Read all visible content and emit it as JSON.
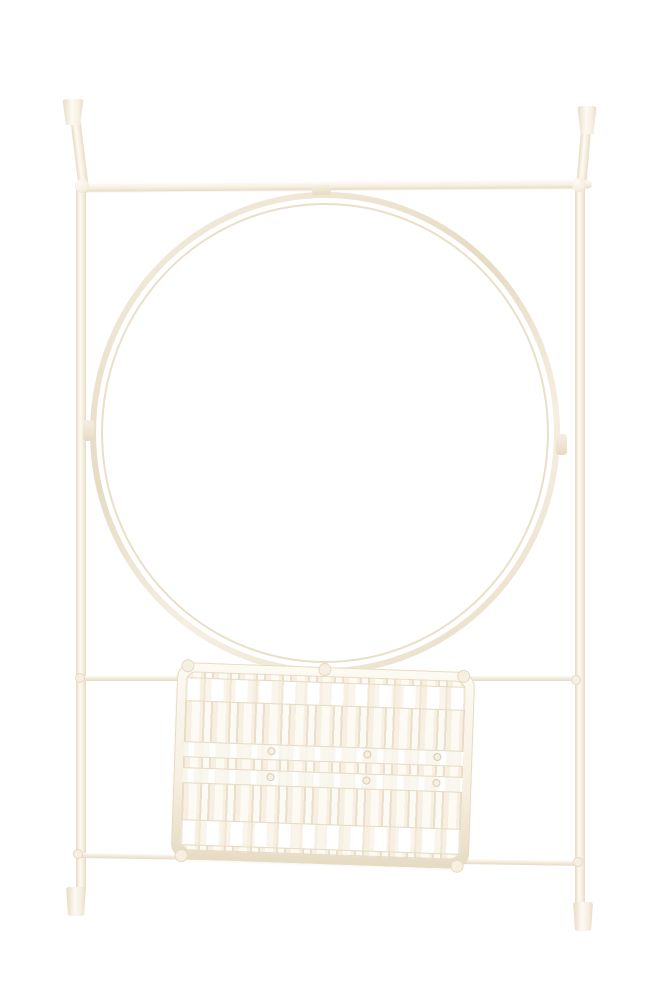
{
  "scene": {
    "title": "Distressed cream-white metal wall rack with tapered finial posts, a large circular hoop frame, and a woven slat basket between two lower rails, photographed on a plain white background"
  },
  "colors": {
    "bg": "#ffffff",
    "metal": "#f6efe2",
    "metal-light": "#fdfaf3",
    "metal-edge": "#e6dbc3",
    "metal-deep": "#d9ccb1",
    "slat-white": "#ffffff",
    "slat-shadow": "#eadfc9"
  },
  "parts": {
    "left_post": "left vertical post",
    "right_post": "right vertical post",
    "top_bar": "top crossbar",
    "hoop": "circular hoop frame",
    "upper_rail": "upper basket rail",
    "lower_rail": "lower basket rail",
    "basket": "woven slat basket",
    "finial": "tapered finial cap",
    "foot": "cylindrical foot cap"
  }
}
